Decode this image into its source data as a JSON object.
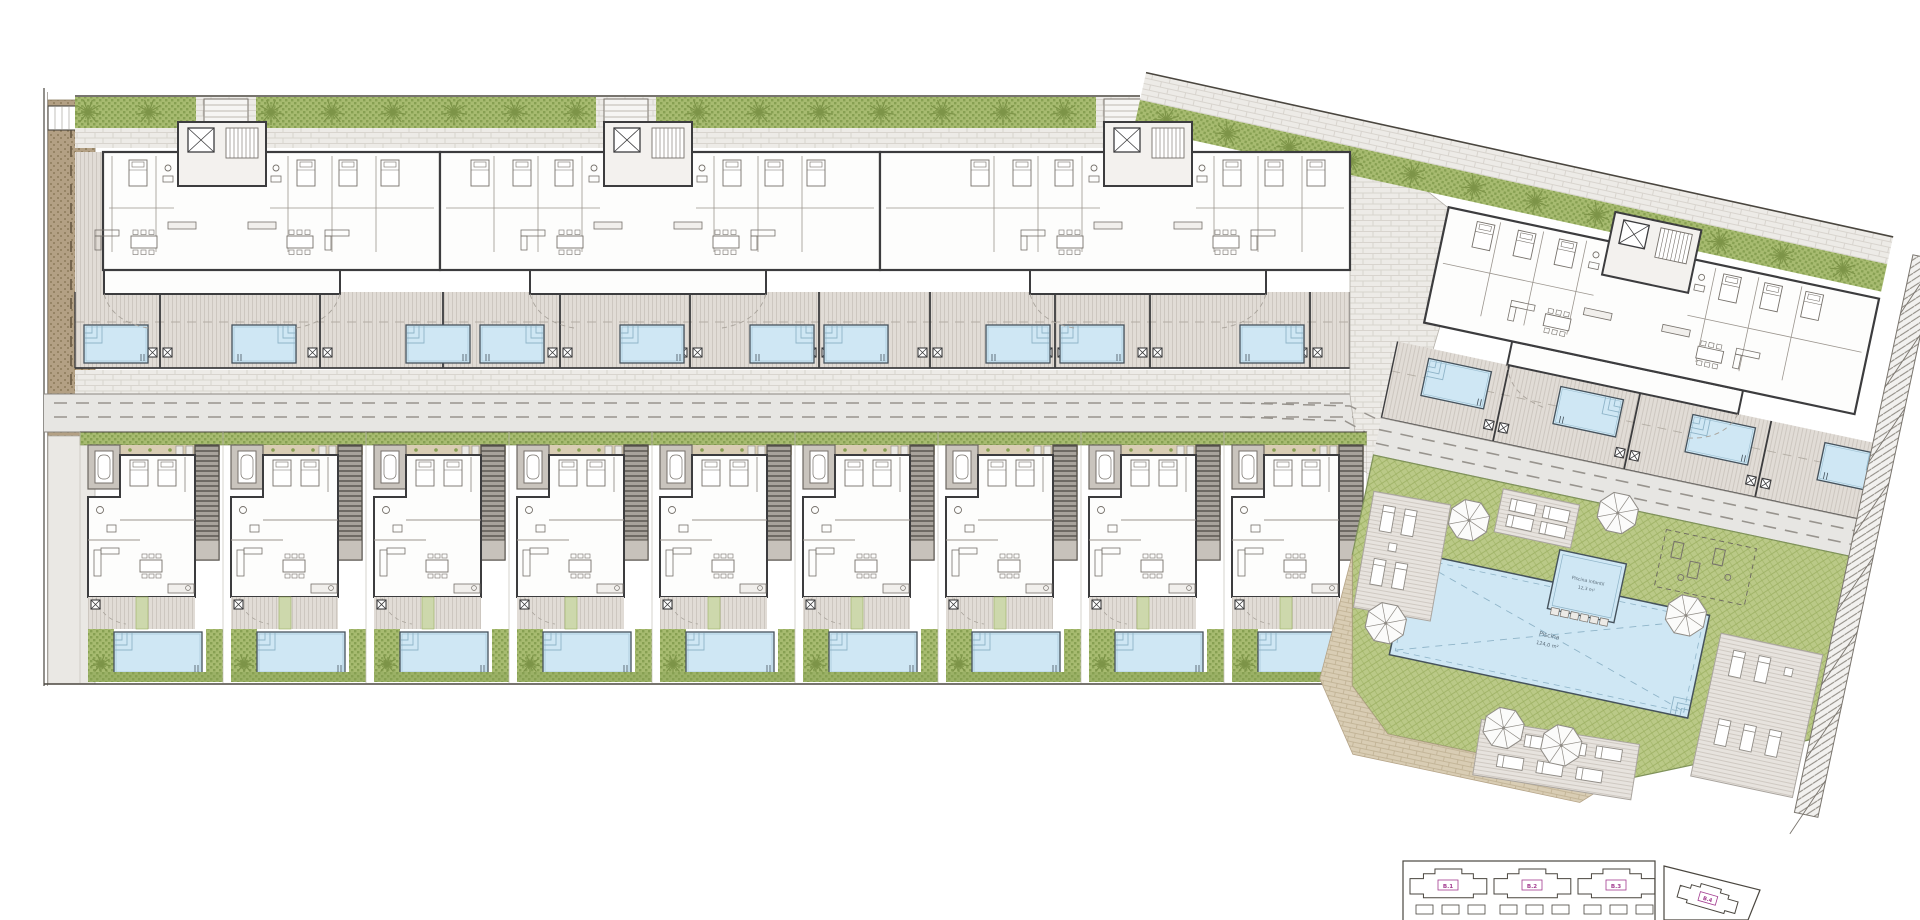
{
  "plan": {
    "w": 1920,
    "h": 920,
    "background": "#ffffff"
  },
  "palette": {
    "line": "#4a463f",
    "wall": "#3c3c3e",
    "furn": "#76716b",
    "roomFill": "#fdfdfc",
    "deckBase": "#e1dcd6",
    "deckLine": "#cdc7c0",
    "brickBase": "#edebe7",
    "brickLine": "#d8d4ce",
    "roadBase": "#e7e6e3",
    "roadLine": "#98948e",
    "roadEdge": "#8b8781",
    "gravelBase": "#b3a084",
    "gravelDot": "#82704f",
    "hedge": "#a7bb70",
    "hedgeDark": "#87a052",
    "tree": "#7d9448",
    "lawnBase": "#bac987",
    "lawnLine": "#9db163",
    "lawnEdge": "#7f925a",
    "poolFill": "#cfe7f4",
    "poolEdge": "#45525c",
    "poolStep": "#8fb4c8",
    "stairBase": "#a8a39c",
    "stairLine": "#4f4b46",
    "patioGray": "#c9c4bd",
    "tan": "#d9cdb4",
    "tanLine": "#bfb092",
    "hatchGray": "#8d8880",
    "parasol": "#fbfbfa",
    "parasolEdge": "#8f8b85",
    "magenta": "#a23b8f",
    "labelBlue": "#5a6b78"
  },
  "labels": {
    "main_pool_line1": "Piscina",
    "main_pool_line2": "124,0 m²",
    "kids_pool_line1": "Piscina infantil",
    "kids_pool_line2": "12,3 m²"
  },
  "hedge_top": {
    "x1": 75,
    "x2": 1140,
    "y": 97,
    "h": 31,
    "gaps": [
      [
        196,
        256
      ],
      [
        596,
        656
      ],
      [
        1096,
        1156
      ]
    ],
    "trees": [
      88,
      149,
      271,
      332,
      393,
      454,
      515,
      576,
      698,
      759,
      820,
      881,
      942,
      1003,
      1064
    ]
  },
  "hedge_right": {
    "angle": 12.4,
    "px": 1140,
    "py": 100,
    "x2": 1905,
    "tree_start": 1170,
    "tree_step": 63,
    "tree_count": 12
  },
  "gravel_path": {
    "x": 48,
    "y": 100,
    "w": 47,
    "h": 336
  },
  "left_path": {
    "x": 48,
    "y": 436,
    "w": 47,
    "h": 248
  },
  "corner_box": {
    "x": 48,
    "y": 106,
    "w": 28,
    "h": 24
  },
  "top_row": {
    "buildings": [
      {
        "x1": 103,
        "x2": 440,
        "cx": 222
      },
      {
        "x1": 440,
        "x2": 880,
        "cx": 648
      },
      {
        "x1": 880,
        "x2": 1350,
        "cx": 1148
      }
    ],
    "deck": {
      "x1": 75,
      "x2": 1350,
      "y": 292,
      "h": 76,
      "dividers": [
        160,
        320,
        443,
        560,
        690,
        819,
        930,
        1055,
        1150,
        1310
      ]
    },
    "pools": {
      "xs": [
        84,
        232,
        406,
        480,
        620,
        750,
        824,
        986,
        1060,
        1240
      ],
      "y": 325,
      "w": 64,
      "h": 38
    }
  },
  "sidewalk": {
    "y": 370,
    "h": 24
  },
  "street": {
    "x1": 44,
    "x2": 1362,
    "y": 394,
    "h": 38,
    "dash_y": [
      403,
      417
    ]
  },
  "townhouses": {
    "start_x": 80,
    "pitch": 143,
    "count": 9,
    "top_y": 432,
    "bottom_y": 683
  },
  "junction": {
    "poly": [
      [
        1350,
        130
      ],
      [
        1470,
        225
      ],
      [
        1430,
        360
      ],
      [
        1500,
        520
      ],
      [
        1360,
        470
      ],
      [
        1350,
        395
      ]
    ],
    "dashes": [
      [
        [
          1240,
          403
        ],
        [
          1350,
          406
        ],
        [
          1430,
          445
        ],
        [
          1500,
          492
        ]
      ],
      [
        [
          1240,
          417
        ],
        [
          1345,
          421
        ],
        [
          1420,
          462
        ],
        [
          1485,
          508
        ]
      ]
    ]
  },
  "right_section": {
    "angle": 12,
    "px": 1400,
    "py": 340,
    "building": {
      "x1": 1420,
      "x2": 1860,
      "cx": 1628,
      "top": 200
    },
    "deck": {
      "x1": 1398,
      "x2": 1895,
      "y": 342,
      "h": 78,
      "dividers": [
        1512,
        1646,
        1780
      ]
    },
    "pools": {
      "xs": [
        1432,
        1567,
        1702,
        1837
      ],
      "y": 352,
      "w": 64,
      "h": 38
    },
    "road": {
      "x1": 1398,
      "x2": 1908,
      "y": 420,
      "h": 38,
      "dash_y": [
        432,
        446
      ]
    },
    "lawn": [
      [
        1398,
        458
      ],
      [
        1886,
        458
      ],
      [
        1886,
        645
      ],
      [
        1700,
        728
      ],
      [
        1470,
        728
      ],
      [
        1425,
        688
      ],
      [
        1398,
        560
      ]
    ],
    "beige_path": [
      [
        1398,
        560
      ],
      [
        1425,
        688
      ],
      [
        1470,
        728
      ],
      [
        1700,
        728
      ],
      [
        1672,
        755
      ],
      [
        1440,
        755
      ],
      [
        1392,
        688
      ]
    ],
    "main_pool": {
      "x": 1455,
      "y": 545,
      "w": 305,
      "h": 105
    },
    "kids_pool": {
      "x": 1600,
      "y": 512,
      "w": 68,
      "h": 60
    },
    "sun_decks": [
      {
        "x": 1408,
        "y": 492,
        "w": 78,
        "h": 118,
        "rot": -2,
        "loungers": "v2"
      },
      {
        "x": 1532,
        "y": 464,
        "w": 78,
        "h": 44,
        "rot": 0,
        "loungers": "h2"
      },
      {
        "x": 1775,
        "y": 560,
        "w": 104,
        "h": 146,
        "rot": 0,
        "loungers": "v4"
      },
      {
        "x": 1560,
        "y": 690,
        "w": 160,
        "h": 56,
        "rot": -3,
        "loungers": "h4"
      }
    ],
    "gym": {
      "x": 1700,
      "y": 470,
      "w": 92,
      "h": 58
    },
    "parasols": [
      [
        1649,
        464
      ],
      [
        1737,
        550
      ],
      [
        1505,
        502
      ],
      [
        1445,
        620
      ],
      [
        1582,
        698
      ],
      [
        1642,
        703
      ]
    ],
    "boundary_strip": {
      "x": 1884,
      "y": 150,
      "w": 24,
      "h": 570
    }
  },
  "inset": {
    "x": 1403,
    "y": 861,
    "w": 252,
    "h": 70,
    "blocks": [
      {
        "x": 1410,
        "label": "B.1"
      },
      {
        "x": 1494,
        "label": "B.2"
      },
      {
        "x": 1578,
        "label": "B.3"
      }
    ],
    "quad": [
      [
        1664,
        866
      ],
      [
        1760,
        890
      ],
      [
        1748,
        920
      ],
      [
        1664,
        920
      ]
    ],
    "b4": {
      "label": "B.4",
      "cx": 1708,
      "cy": 898,
      "rot": 16
    }
  }
}
